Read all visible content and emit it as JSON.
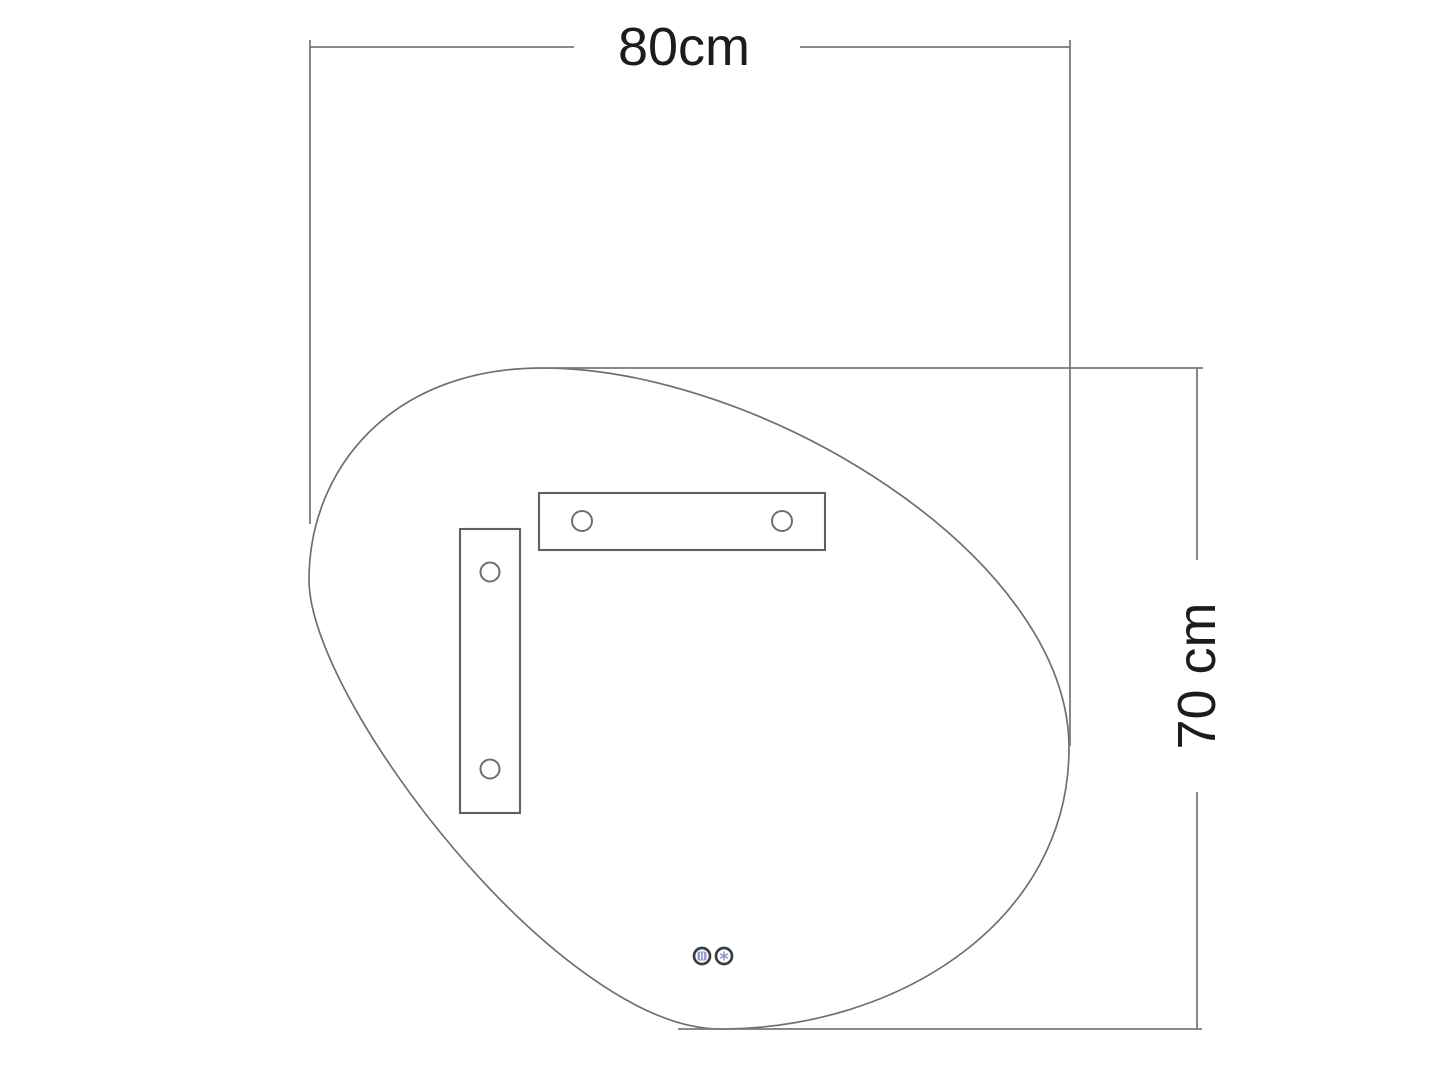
{
  "diagram": {
    "description": "Dimension drawing of an asymmetric pebble-shaped mirror with two mounting brackets, two touch-sensor buttons and width/height dimension lines",
    "colors": {
      "background": "#ffffff",
      "dimension_line": "#7a7a7a",
      "outline": "#6f6f6f",
      "bracket": "#606060",
      "text": "#1c1c1c",
      "sensor_ring": "#3c3c44",
      "sensor_glyph": "#9099d8"
    },
    "dimensions": {
      "width": {
        "label": "80cm"
      },
      "height": {
        "label": "70 cm"
      }
    },
    "icons": [
      {
        "name": "light-sensor-icon"
      },
      {
        "name": "defog-sensor-icon"
      }
    ]
  }
}
